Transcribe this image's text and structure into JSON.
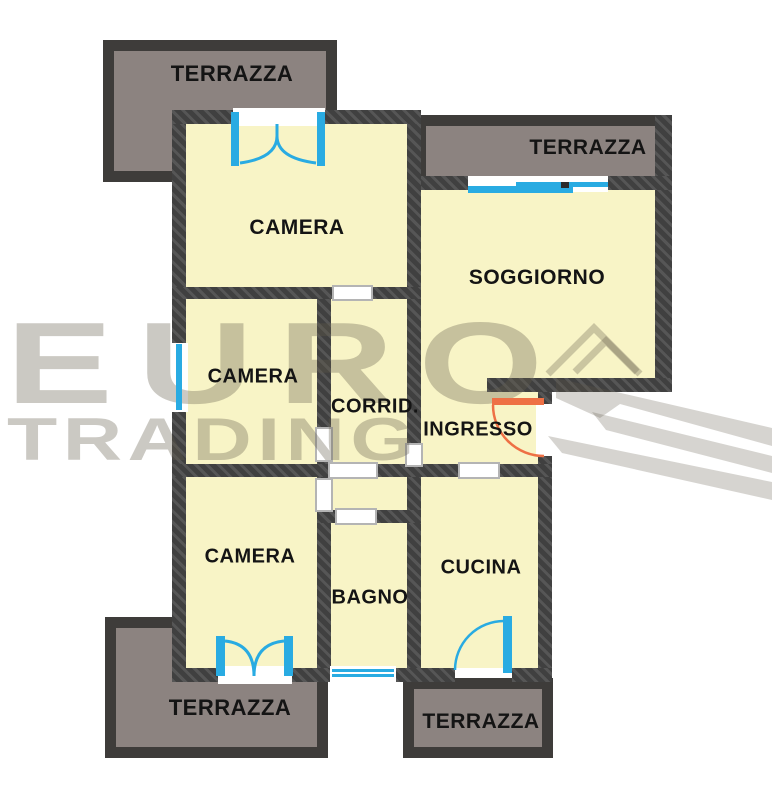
{
  "watermark": {
    "line1": "EURO",
    "line2": "TRADING",
    "logo": "arrow-swoosh"
  },
  "rooms": {
    "camera_top": {
      "label": "CAMERA"
    },
    "camera_mid": {
      "label": "CAMERA"
    },
    "camera_bottom": {
      "label": "CAMERA"
    },
    "soggiorno": {
      "label": "SOGGIORNO"
    },
    "corridoio": {
      "label": "CORRID."
    },
    "ingresso": {
      "label": "INGRESSO"
    },
    "bagno": {
      "label": "BAGNO"
    },
    "cucina": {
      "label": "CUCINA"
    }
  },
  "terraces": {
    "top_left": {
      "label": "TERRAZZA"
    },
    "top_right": {
      "label": "TERRAZZA"
    },
    "bottom_left": {
      "label": "TERRAZZA"
    },
    "bottom_right": {
      "label": "TERRAZZA"
    }
  },
  "colors": {
    "room_fill": "#F8F4C6",
    "wall": "#454545",
    "terrace_fill": "#8C8380",
    "terrace_wall": "#3E3C3A",
    "door_window_blue": "#29ABE2",
    "entrance_door_orange": "#EE7045",
    "watermark_gray": "#CDCAC3",
    "label_black": "#141414"
  }
}
